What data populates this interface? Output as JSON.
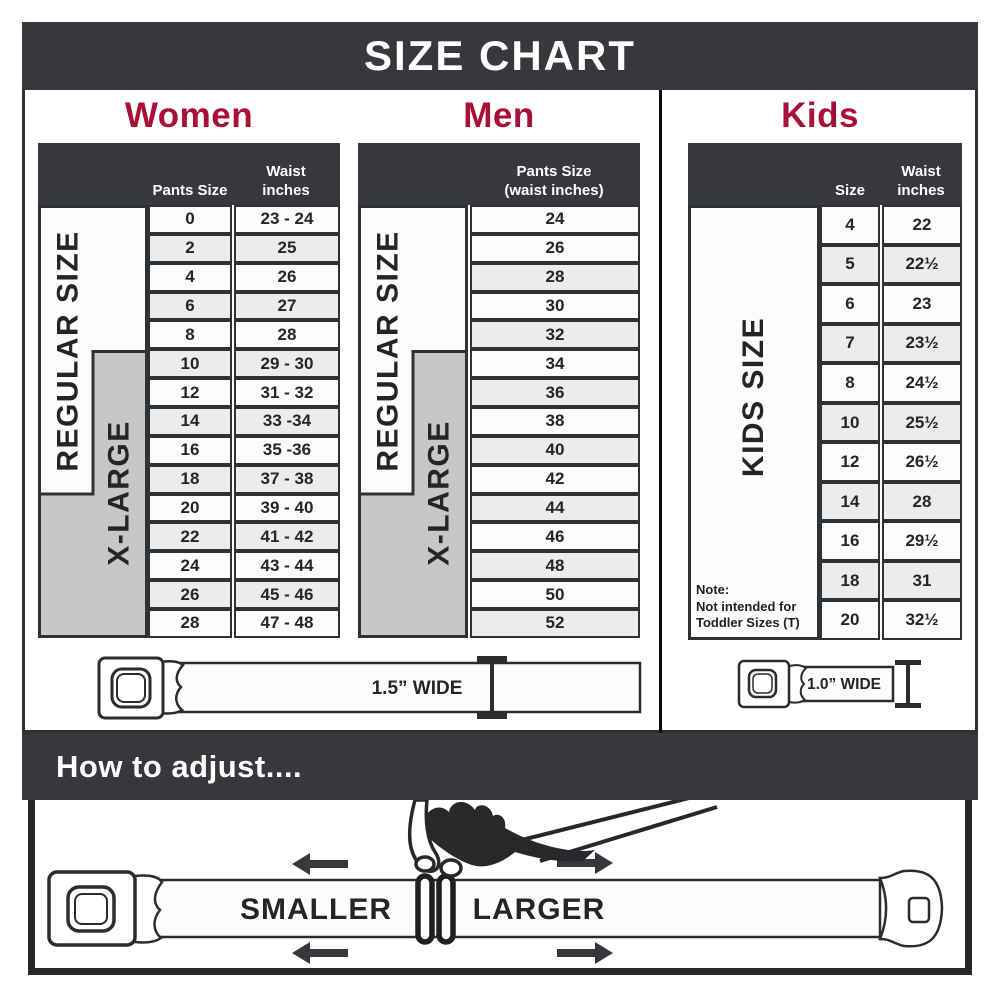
{
  "title": "SIZE CHART",
  "theme": {
    "dark_bar": "#36383b",
    "accent_red": "#a81038",
    "row_alt_gray": "#ececec",
    "xlarge_gray": "#c7c7c7"
  },
  "sections": {
    "women": {
      "heading": "Women",
      "regular_label": "REGULAR SIZE",
      "xlarge_label": "X-LARGE",
      "columns": [
        "Pants Size",
        "Waist\ninches"
      ],
      "rows": [
        {
          "size": "0",
          "waist": "23 - 24"
        },
        {
          "size": "2",
          "waist": "25"
        },
        {
          "size": "4",
          "waist": "26"
        },
        {
          "size": "6",
          "waist": "27"
        },
        {
          "size": "8",
          "waist": "28"
        },
        {
          "size": "10",
          "waist": "29 - 30"
        },
        {
          "size": "12",
          "waist": "31 - 32"
        },
        {
          "size": "14",
          "waist": "33 -34"
        },
        {
          "size": "16",
          "waist": "35 -36"
        },
        {
          "size": "18",
          "waist": "37 - 38"
        },
        {
          "size": "20",
          "waist": "39 - 40"
        },
        {
          "size": "22",
          "waist": "41 - 42"
        },
        {
          "size": "24",
          "waist": "43 - 44"
        },
        {
          "size": "26",
          "waist": "45 - 46"
        },
        {
          "size": "28",
          "waist": "47 - 48"
        }
      ]
    },
    "men": {
      "heading": "Men",
      "regular_label": "REGULAR SIZE",
      "xlarge_label": "X-LARGE",
      "column": "Pants Size\n(waist inches)",
      "rows": [
        "24",
        "26",
        "28",
        "30",
        "32",
        "34",
        "36",
        "38",
        "40",
        "42",
        "44",
        "46",
        "48",
        "50",
        "52"
      ]
    },
    "kids": {
      "heading": "Kids",
      "side_label": "KIDS SIZE",
      "columns": [
        "Size",
        "Waist\ninches"
      ],
      "rows": [
        {
          "size": "4",
          "waist": "22"
        },
        {
          "size": "5",
          "waist": "22½"
        },
        {
          "size": "6",
          "waist": "23"
        },
        {
          "size": "7",
          "waist": "23½"
        },
        {
          "size": "8",
          "waist": "24½"
        },
        {
          "size": "10",
          "waist": "25½"
        },
        {
          "size": "12",
          "waist": "26½"
        },
        {
          "size": "14",
          "waist": "28"
        },
        {
          "size": "16",
          "waist": "29½"
        },
        {
          "size": "18",
          "waist": "31"
        },
        {
          "size": "20",
          "waist": "32½"
        }
      ],
      "note": [
        "Note:",
        "Not intended for",
        "Toddler Sizes (T)"
      ]
    }
  },
  "belts": {
    "adult_width": "1.5” WIDE",
    "kids_width": "1.0” WIDE"
  },
  "how_to_adjust": {
    "heading": "How to adjust....",
    "smaller": "SMALLER",
    "larger": "LARGER"
  }
}
